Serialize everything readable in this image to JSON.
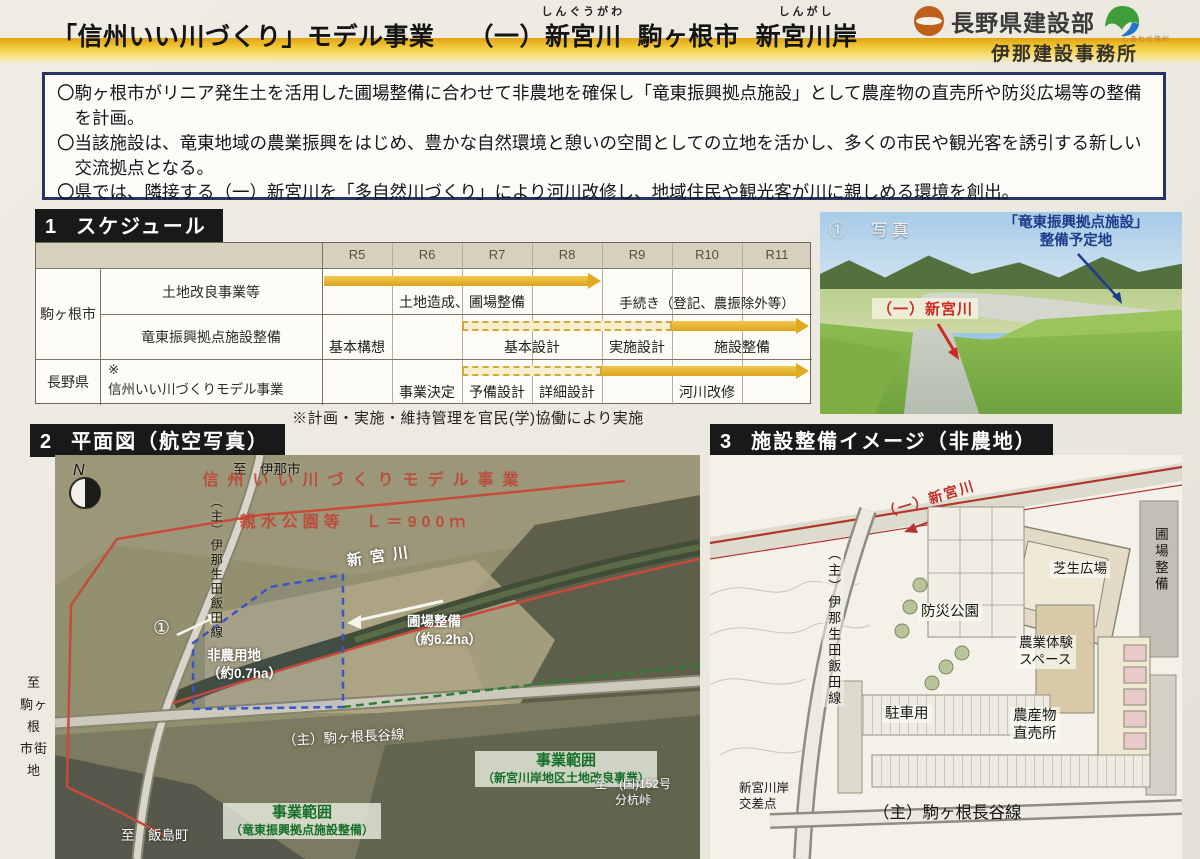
{
  "header": {
    "title_main": "「信州いい川づくり」モデル事業",
    "river_prefix": "（一）",
    "river_name": "新宮川",
    "river_ruby": "しんぐうがわ",
    "city": "駒ヶ根市",
    "site_name": "新宮川岸",
    "site_ruby": "しんがし",
    "org": "長野県建設部",
    "org_caption": "しあわせ信州",
    "office": "伊那建設事務所"
  },
  "summary": {
    "bullets": [
      "〇駒ヶ根市がリニア発生土を活用した圃場整備に合わせて非農地を確保し「竜東振興拠点施設」として農産物の直売所や防災広場等の整備を計画。",
      "〇当該施設は、竜東地域の農業振興をはじめ、豊かな自然環境と憩いの空間としての立地を活かし、多くの市民や観光客を誘引する新しい交流拠点となる。",
      "〇県では、隣接する（一）新宮川を「多自然川づくり」により河川改修し、地域住民や観光客が川に親しめる環境を創出。"
    ]
  },
  "schedule": {
    "no": "1",
    "title": "スケジュール",
    "years": [
      "R5",
      "R6",
      "R7",
      "R8",
      "R9",
      "R10",
      "R11"
    ],
    "group1": "駒ヶ根市",
    "group2": "長野県",
    "row1_item": "土地改良事業等",
    "row2_item": "竜東振興拠点施設整備",
    "row3_mark": "※",
    "row3_item": "信州いい川づくりモデル事業",
    "row1_label1": "土地造成、圃場整備",
    "row1_label2": "手続き（登記、農振除外等）",
    "row2_label1": "基本構想",
    "row2_label2": "基本設計",
    "row2_label3": "実施設計",
    "row2_label4": "施設整備",
    "row3_label1": "事業決定",
    "row3_label2": "予備設計",
    "row3_label3": "詳細設計",
    "row3_label4": "河川改修",
    "note": "※計画・実施・維持管理を官民(学)協働により実施"
  },
  "photo": {
    "tag": "①　写真",
    "label_line1": "「竜東振興拠点施設」",
    "label_line2": "整備予定地",
    "river_label": "（一）新宮川"
  },
  "aerial": {
    "no": "2",
    "title": "平面図（航空写真）",
    "compass": "N",
    "to_inashi": "至　伊那市",
    "road_vertical": "（主）伊那生田飯田線",
    "red_text1": "信州いい川づくりモデル事業",
    "red_text2": "親水公園等　Ｌ＝900ｍ",
    "river": "新宮川",
    "marker": "①",
    "hinochi_l1": "非農用地",
    "hinochi_l2": "（約0.7ha）",
    "hojo_l1": "圃場整備",
    "hojo_l2": "（約6.2ha）",
    "road_bottom": "（主）駒ヶ根長谷線",
    "scope1_l1": "事業範囲",
    "scope1_l2": "（竜東振興拠点施設整備）",
    "scope2_l1": "事業範囲",
    "scope2_l2": "（新宮川岸地区土地改良事業）",
    "to_152_l1": "至　(国)152号",
    "to_152_l2": "分杭峠",
    "to_iijima": "至　飯島町",
    "to_komagane_l1": "至",
    "to_komagane_l2": "駒ヶ根",
    "to_komagane_l3": "市街地"
  },
  "siteplan": {
    "no": "3",
    "title": "施設整備イメージ（非農地）",
    "river": "（一）新宮川",
    "road_vertical": "（主）伊那生田飯田線",
    "lawn": "芝生広場",
    "farm_exp_l1": "農業体験",
    "farm_exp_l2": "スペース",
    "bosai": "防災公園",
    "chokubai_l1": "農産物",
    "chokubai_l2": "直売所",
    "parking": "駐車用",
    "hojo": "圃場整備",
    "crossing_l1": "新宮川岸",
    "crossing_l2": "交差点",
    "road_bottom": "（主）駒ヶ根長谷線"
  }
}
